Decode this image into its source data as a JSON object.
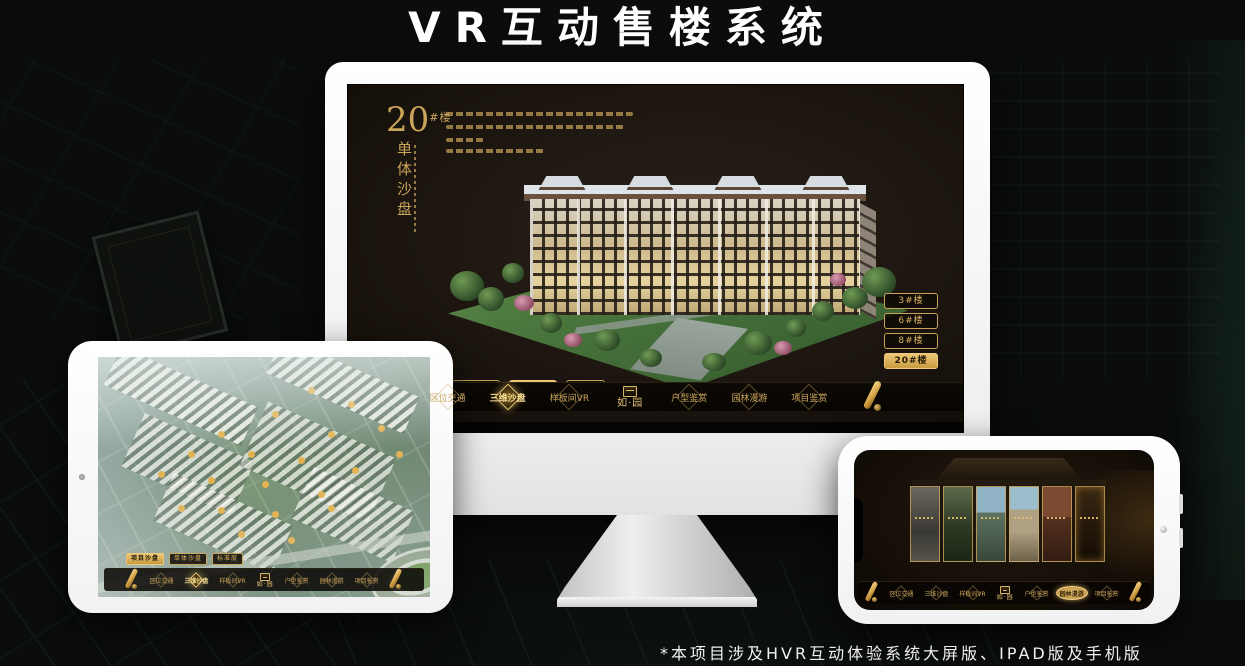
{
  "page": {
    "title": "VR互动售楼系统",
    "footnote": "*本项目涉及HVR互动体验系统大屏版、IPAD版及手机版"
  },
  "brand": {
    "logo_text": "如·园",
    "accent_gold": "#c9a45a",
    "selected_gold_bg": "#d8ab55",
    "screen_bg": "#1e1710"
  },
  "monitor_app": {
    "heading": {
      "number": "20",
      "unit": "#楼",
      "subtitle_vertical": "单体沙盘"
    },
    "building_buttons": [
      {
        "label": "3#楼"
      },
      {
        "label": "6#楼"
      },
      {
        "label": "8#楼"
      },
      {
        "label": "20#楼"
      }
    ],
    "selected_building": "20#楼",
    "sub_tabs": [
      {
        "label": "项目沙盘"
      },
      {
        "label": "单体沙盘"
      },
      {
        "label": "标准层"
      }
    ],
    "selected_sub_tab": "单体沙盘",
    "nav_items": [
      {
        "label": "区位交通"
      },
      {
        "label": "三维沙盘"
      },
      {
        "label": "样板间VR"
      },
      {
        "label": "户型鉴赏"
      },
      {
        "label": "园林漫游"
      },
      {
        "label": "项目鉴赏"
      }
    ],
    "selected_nav_item": "三维沙盘",
    "logo_text": "如·园"
  },
  "ipad_app": {
    "sub_tabs": [
      {
        "label": "项目沙盘"
      },
      {
        "label": "单体沙盘"
      },
      {
        "label": "标准层"
      }
    ],
    "selected_sub_tab": "项目沙盘",
    "nav_items": [
      {
        "label": "区位交通"
      },
      {
        "label": "三维沙盘"
      },
      {
        "label": "样板间VR"
      },
      {
        "label": "户型鉴赏"
      },
      {
        "label": "园林漫游"
      },
      {
        "label": "项目鉴赏"
      }
    ],
    "logo_text": "如·园"
  },
  "phone_app": {
    "nav_items": [
      {
        "label": "区位交通"
      },
      {
        "label": "三维沙盘"
      },
      {
        "label": "样板间VR"
      },
      {
        "label": "户型鉴赏"
      },
      {
        "label": "园林漫游"
      },
      {
        "label": "项目鉴赏"
      }
    ],
    "selected_nav_item": "园林漫游",
    "logo_text": "如·园"
  }
}
